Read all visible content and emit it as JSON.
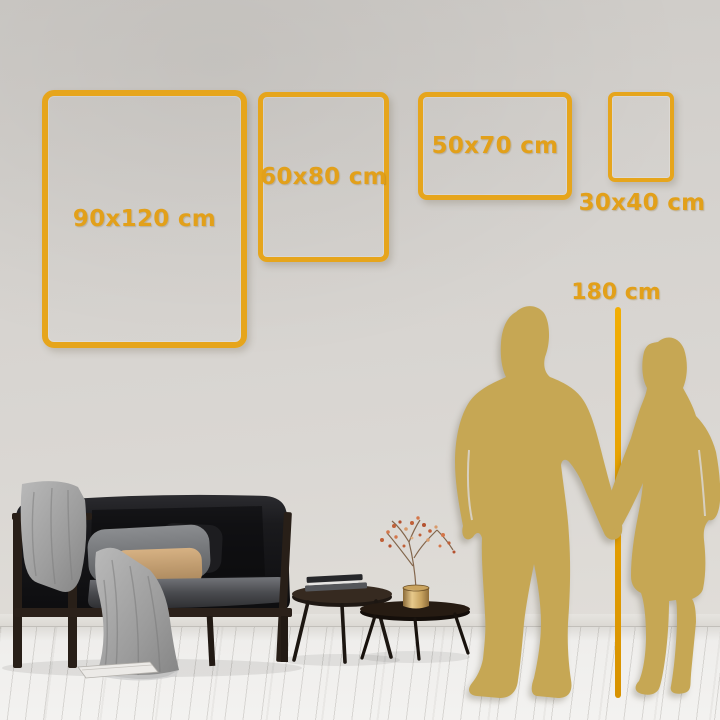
{
  "guide": {
    "frames": [
      {
        "label": "90x120 cm",
        "width_cm": 90,
        "height_cm": 120,
        "orientation": "portrait"
      },
      {
        "label": "60x80 cm",
        "width_cm": 60,
        "height_cm": 80,
        "orientation": "portrait"
      },
      {
        "label": "50x70 cm",
        "width_cm": 50,
        "height_cm": 70,
        "orientation": "landscape"
      },
      {
        "label": "30x40 cm",
        "width_cm": 30,
        "height_cm": 40,
        "orientation": "portrait"
      }
    ],
    "height_reference": {
      "label": "180 cm",
      "value_cm": 180
    }
  },
  "colors": {
    "frame_gold": "#E6A51C",
    "label_gold": "#E2A01A",
    "silhouette_gold": "#C6A754",
    "measure_line_top": "#F2AE04",
    "measure_line_bottom": "#D89200",
    "wall": "#D6D3CF",
    "floor": "#F1F0EE"
  },
  "scene": {
    "objects": [
      "sofa",
      "throw-blanket",
      "gray-pillow",
      "tan-pillow",
      "coffee-tables",
      "books",
      "vase-with-dried-flowers",
      "magazine-on-floor",
      "man-silhouette",
      "woman-silhouette"
    ]
  }
}
